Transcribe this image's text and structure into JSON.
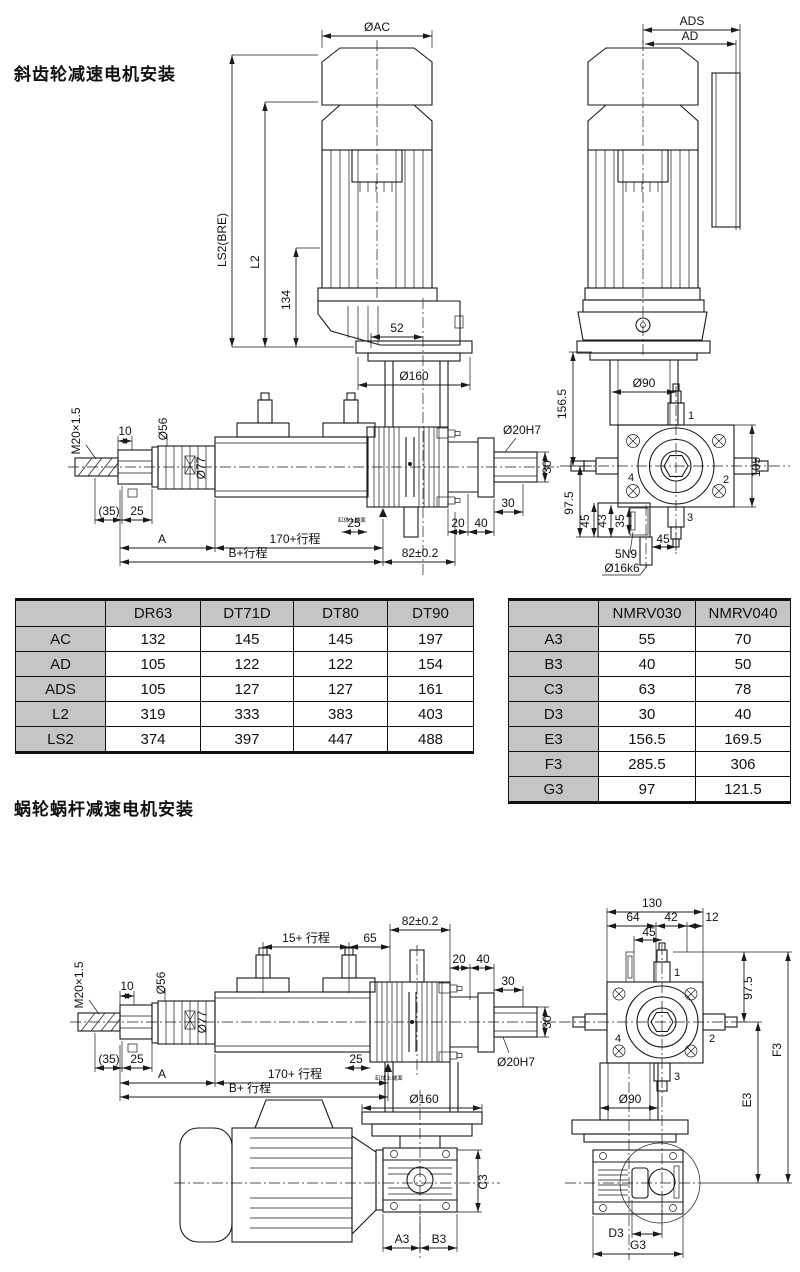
{
  "titles": {
    "helical": "斜齿轮减速电机安装",
    "worm": "蜗轮蜗杆减速电机安装"
  },
  "colors": {
    "line": "#1a1a1a",
    "table_header_bg": "#c5c5c5",
    "background": "#ffffff"
  },
  "helical": {
    "front": {
      "oac": "ØAC",
      "ls2": "LS2(BRE)",
      "l2": "L2",
      "h134": "134",
      "w52": "52",
      "o160": "Ø160",
      "m20": "M20×1.5",
      "t10": "10",
      "o56": "Ø56",
      "o77": "Ø77",
      "p35": "(35)",
      "n25l": "25",
      "A": "A",
      "s170": "170+行程",
      "sB": "B+行程",
      "n25r": "25",
      "t82": "82±0.2",
      "t20": "20",
      "t40": "40",
      "t30a": "30",
      "t30b": "30",
      "o20h7": "Ø20H7",
      "face": "缸体上端面"
    },
    "side": {
      "ads": "ADS",
      "ad": "AD",
      "o90": "Ø90",
      "h156": "156.5",
      "h97": "97.5",
      "h105": "105",
      "p1": "1",
      "p2": "2",
      "p3": "3",
      "p4": "4",
      "k45a": "45",
      "k43": "43",
      "k35": "35",
      "k45b": "45",
      "key": "5N9",
      "o16": "Ø16k6"
    }
  },
  "worm": {
    "front": {
      "s15": "15+ 行程",
      "n65": "65",
      "t82": "82±0.2",
      "t20": "20",
      "t40": "40",
      "t30a": "30",
      "t30b": "30",
      "o20h7": "Ø20H7",
      "m20": "M20×1.5",
      "t10": "10",
      "o56": "Ø56",
      "o77": "Ø77",
      "p35": "(35)",
      "n25l": "25",
      "A": "A",
      "s170": "170+ 行程",
      "sB": "B+ 行程",
      "n25r": "25",
      "face": "缸体上端面",
      "o160": "Ø160",
      "c3": "C3",
      "a3": "A3",
      "b3": "B3"
    },
    "side": {
      "w130": "130",
      "w64": "64",
      "w42": "42",
      "w12": "12",
      "w45": "45",
      "p1": "1",
      "p2": "2",
      "p3": "3",
      "p4": "4",
      "h97": "97.5",
      "f3": "F3",
      "e3": "E3",
      "o90": "Ø90",
      "d3": "D3",
      "g3": "G3"
    }
  },
  "table1": {
    "headers": [
      "",
      "DR63",
      "DT71D",
      "DT80",
      "DT90"
    ],
    "rows": [
      {
        "label": "AC",
        "values": [
          "132",
          "145",
          "145",
          "197"
        ]
      },
      {
        "label": "AD",
        "values": [
          "105",
          "122",
          "122",
          "154"
        ]
      },
      {
        "label": "ADS",
        "values": [
          "105",
          "127",
          "127",
          "161"
        ]
      },
      {
        "label": "L2",
        "values": [
          "319",
          "333",
          "383",
          "403"
        ]
      },
      {
        "label": "LS2",
        "values": [
          "374",
          "397",
          "447",
          "488"
        ]
      }
    ]
  },
  "table2": {
    "headers": [
      "",
      "NMRV030",
      "NMRV040"
    ],
    "rows": [
      {
        "label": "A3",
        "values": [
          "55",
          "70"
        ]
      },
      {
        "label": "B3",
        "values": [
          "40",
          "50"
        ]
      },
      {
        "label": "C3",
        "values": [
          "63",
          "78"
        ]
      },
      {
        "label": "D3",
        "values": [
          "30",
          "40"
        ]
      },
      {
        "label": "E3",
        "values": [
          "156.5",
          "169.5"
        ]
      },
      {
        "label": "F3",
        "values": [
          "285.5",
          "306"
        ]
      },
      {
        "label": "G3",
        "values": [
          "97",
          "121.5"
        ]
      }
    ]
  }
}
